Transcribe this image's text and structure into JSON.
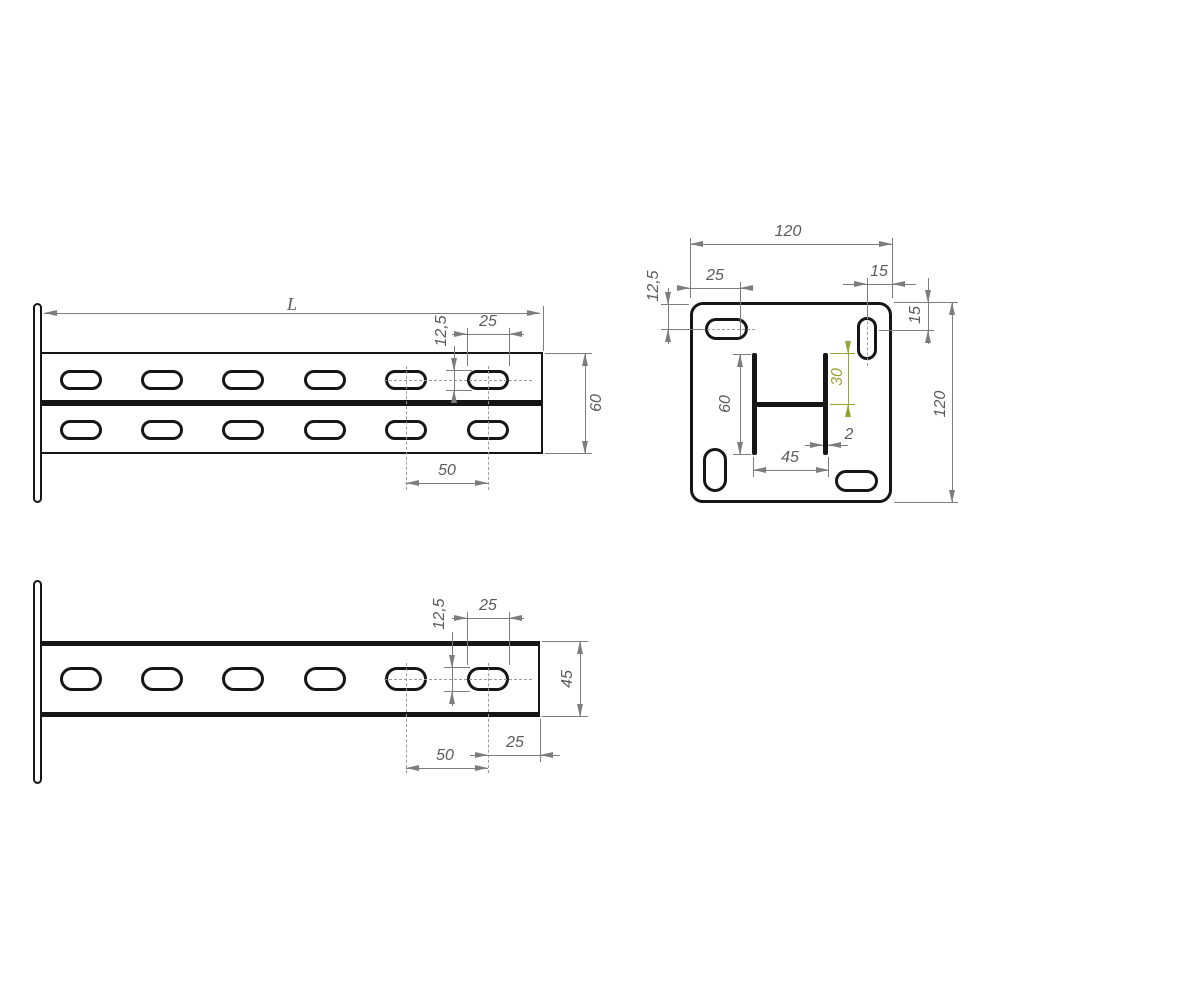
{
  "drawing_title": "console-bracket-technical-drawing",
  "colors": {
    "outline": "#161616",
    "dimension": "#7d7d7d",
    "accent_green": "#97a336"
  },
  "views": {
    "side_view_60": {
      "name": "side view, double channel bracket h=60",
      "dims": {
        "length": "L",
        "slot_length": "25",
        "slot_width": "12,5",
        "height": "60",
        "slot_pitch": "50"
      }
    },
    "plate_view": {
      "name": "mounting plate face view 120x120 with channel cross-section",
      "dims": {
        "plate_width": "120",
        "slot_offset_left": "25",
        "slot_offset_top_right": "15",
        "slot_edge_left": "12,5",
        "slot_edge_right": "15",
        "plate_height": "120",
        "profile_height": "60",
        "profile_half_height": "30",
        "wall_thickness": "2",
        "profile_width": "45"
      }
    },
    "side_view_45": {
      "name": "side view, single channel bracket h=45",
      "dims": {
        "slot_length": "25",
        "slot_width": "12,5",
        "height": "45",
        "end_offset": "25",
        "slot_pitch": "50"
      }
    }
  }
}
